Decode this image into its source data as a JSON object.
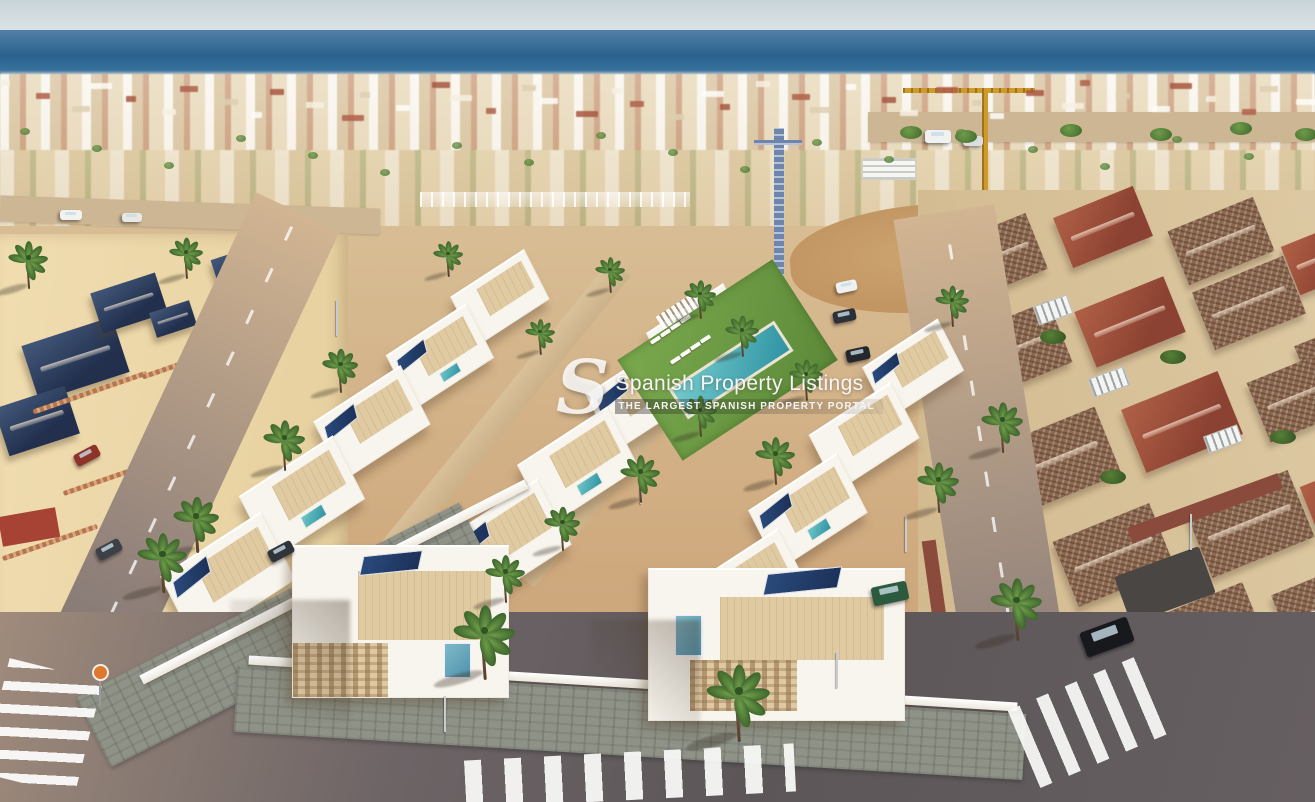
{
  "watermark": {
    "logo_letter": "S",
    "title": "Spanish Property Listings",
    "tagline": "THE LARGEST SPANISH PROPERTY PORTAL"
  },
  "scene": {
    "caption": "Aerial render of a new-build complex of white villas with roof terraces, solar panels and a communal lawn with pool, set between existing Mediterranean villas near the sea",
    "colors": {
      "sand": "#d6b78e",
      "ocean": "#3f77a3",
      "oceanDeep": "#2a628f",
      "cobble": "#8e9287",
      "villaWhite": "#f8f5ee",
      "terrace": "#e0caa2",
      "solar": "#24416f",
      "pool": "#41a9ae",
      "lawn": "#6d9a44",
      "palm": "#4f7d33",
      "roofBlue": "#2d3d60",
      "roofRed": "#9d4e3b",
      "roofTile": "#8c6850",
      "craneYellow": "#cf9a2a",
      "craneBlue": "#6e86ad",
      "signOrange": "#e0772e",
      "asphalt": "#615a5c"
    }
  }
}
